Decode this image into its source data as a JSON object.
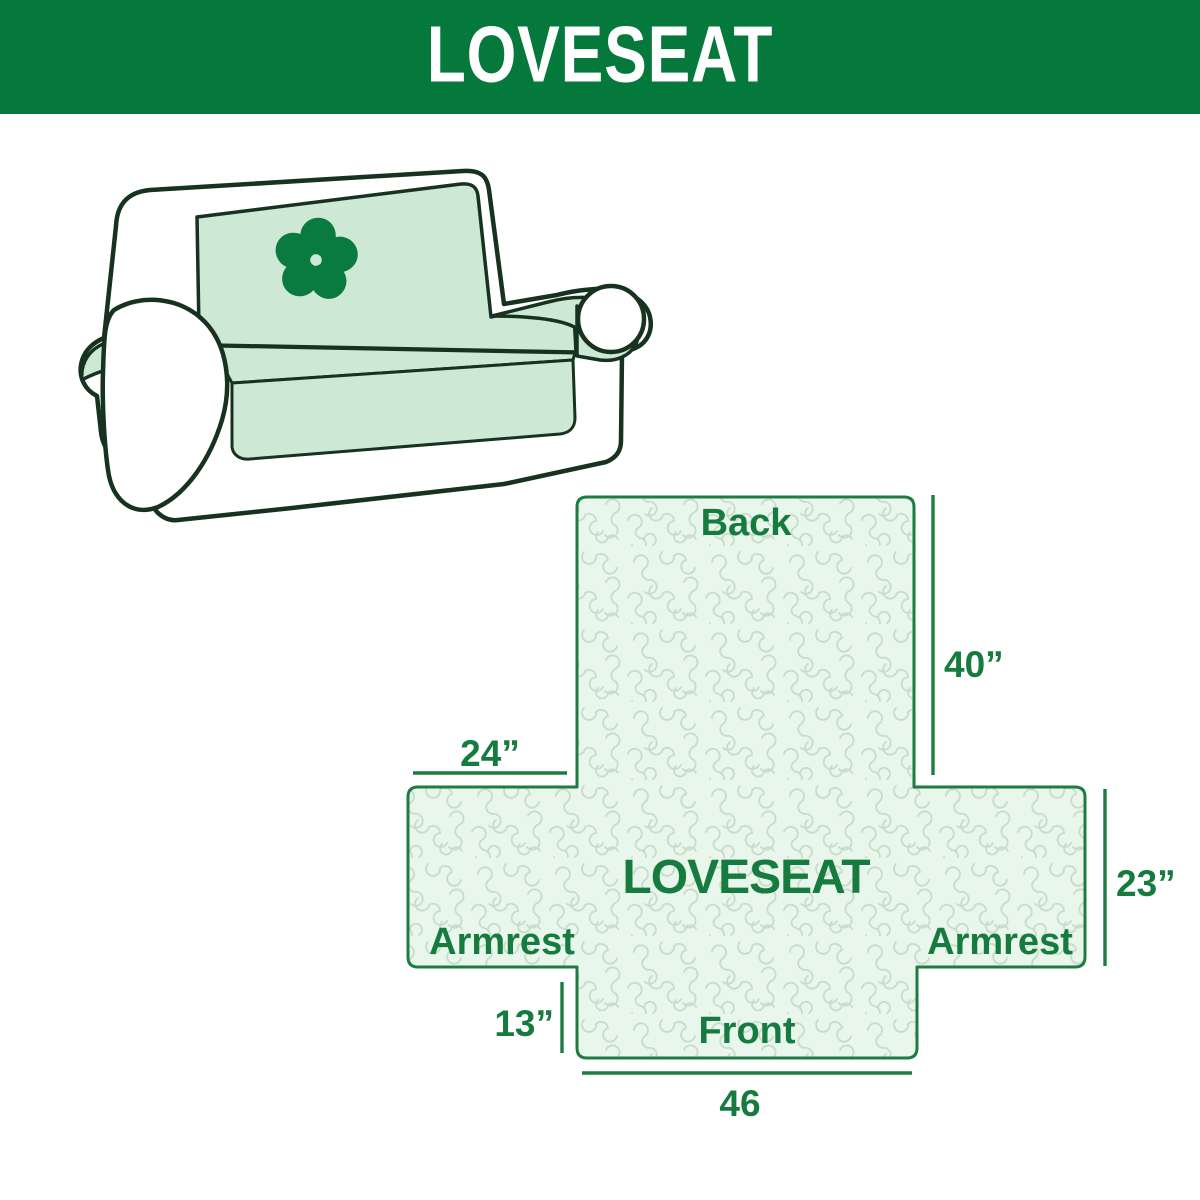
{
  "header": {
    "title": "LOVESEAT"
  },
  "illustration": {
    "subject": "loveseat sofa line drawing with slipcover",
    "logo_icon": "pinwheel-icon"
  },
  "diagram": {
    "center_label": "LOVESEAT",
    "back_label": "Back",
    "front_label": "Front",
    "armrest_left_label": "Armrest",
    "armrest_right_label": "Armrest",
    "dim_back_height": "40”",
    "dim_armrest_top_width": "24”",
    "dim_armrest_side_height": "23”",
    "dim_front_height": "13”",
    "dim_front_width": "46"
  },
  "colors": {
    "header_bg": "#05783b",
    "header_text": "#ffffff",
    "diagram_outline_green": "#1e7c42",
    "diagram_text_green": "#157b3e",
    "diagram_fill": "#e9f6eb",
    "texture_line": "#c8dcc9",
    "sofa_outline": "#17331f",
    "sofa_cover_mint": "#cde9d6",
    "logo_green": "#0a7b3e"
  }
}
